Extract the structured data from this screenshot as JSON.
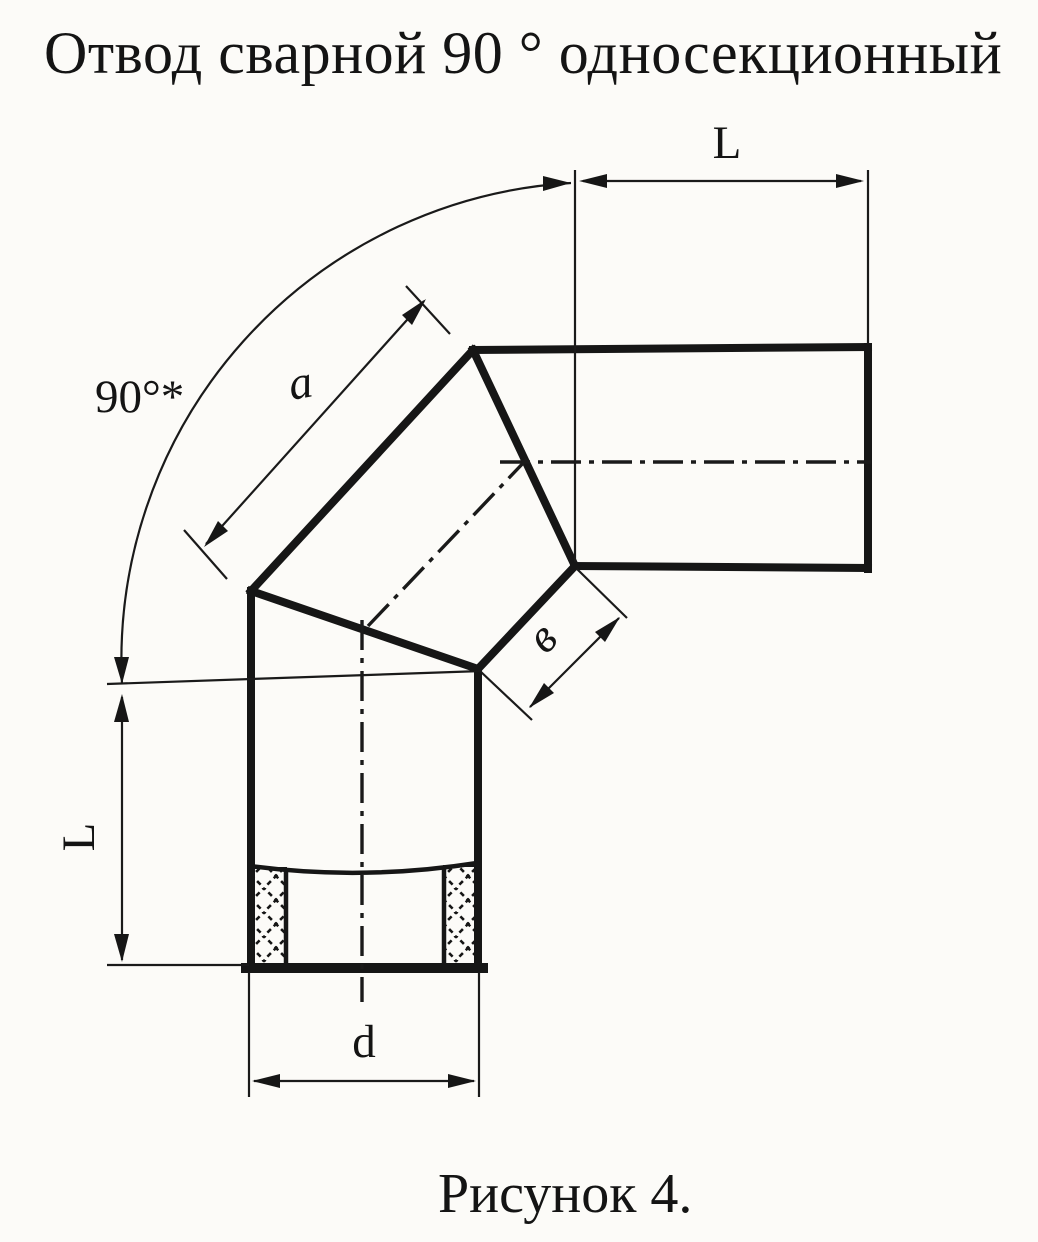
{
  "title": "Отвод сварной 90 ° односекционный",
  "caption": "Рисунок 4.",
  "labels": {
    "length_top": "L",
    "length_left": "L",
    "angle": "90°*",
    "side_a": "a",
    "side_b": "в",
    "diameter": "d"
  },
  "colors": {
    "ink": "#161616",
    "paper": "#fcfbf8"
  }
}
